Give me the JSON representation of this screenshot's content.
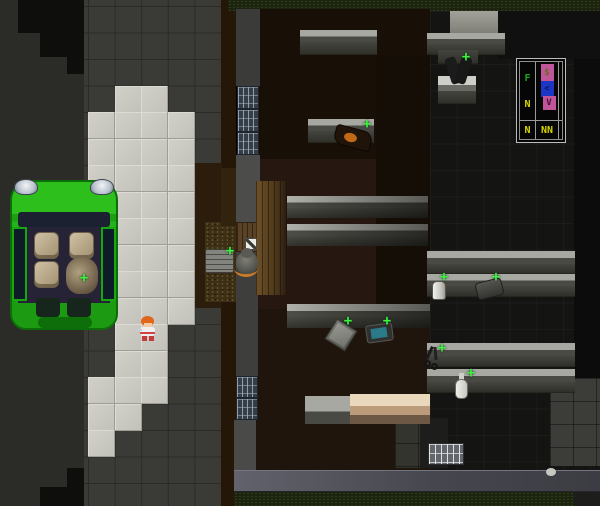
{
  "app": {
    "description": "top-down tile-based survival roguelike game viewport"
  },
  "overlay": {
    "f": "F",
    "n_mid": "N",
    "n_bottom": "N",
    "nn": "NN",
    "dollar": "$",
    "lt": "<",
    "v": "V",
    "letter_green": "#1fa21f",
    "letter_yellow": "#d6d600",
    "bar_pink": "#c0559a",
    "bar_blue": "#1c35c2"
  },
  "scene": {
    "plus_glyph": "+",
    "plus_color": "#3cf53c",
    "grid": {
      "x0": 88,
      "y0": 6,
      "tw": 26.6,
      "th": 26.5
    },
    "light_tiles": [
      [
        1,
        3
      ],
      [
        2,
        3
      ],
      [
        0,
        4
      ],
      [
        1,
        4
      ],
      [
        2,
        4
      ],
      [
        3,
        4
      ],
      [
        0,
        5
      ],
      [
        1,
        5
      ],
      [
        2,
        5
      ],
      [
        3,
        5
      ],
      [
        0,
        6
      ],
      [
        1,
        6
      ],
      [
        2,
        6
      ],
      [
        3,
        6
      ],
      [
        0,
        7
      ],
      [
        1,
        7
      ],
      [
        2,
        7
      ],
      [
        3,
        7
      ],
      [
        1,
        8
      ],
      [
        2,
        8
      ],
      [
        3,
        8
      ],
      [
        1,
        9
      ],
      [
        2,
        9
      ],
      [
        3,
        9
      ],
      [
        1,
        10
      ],
      [
        2,
        10
      ],
      [
        3,
        10
      ],
      [
        1,
        11
      ],
      [
        2,
        11
      ],
      [
        3,
        11
      ],
      [
        1,
        12
      ],
      [
        2,
        12
      ],
      [
        1,
        13
      ],
      [
        2,
        13
      ],
      [
        0,
        14
      ],
      [
        1,
        14
      ],
      [
        2,
        14
      ],
      [
        0,
        15
      ],
      [
        1,
        15
      ],
      [
        0,
        16
      ]
    ],
    "plus_markers": [
      [
        224,
        245
      ],
      [
        78,
        272
      ],
      [
        361,
        118
      ],
      [
        460,
        51
      ],
      [
        342,
        315
      ],
      [
        381,
        315
      ],
      [
        438,
        271
      ],
      [
        490,
        271
      ],
      [
        436,
        342
      ],
      [
        465,
        367
      ]
    ],
    "base": [
      {
        "n": "road-asphalt",
        "x": 0,
        "y": 0,
        "w": 88,
        "h": 506,
        "bg": "#2b2b28"
      },
      {
        "n": "road-dark-patch",
        "x": 18,
        "y": 0,
        "w": 66,
        "h": 33,
        "bg": "#0e0e0d"
      },
      {
        "n": "road-dark-patch",
        "x": 40,
        "y": 33,
        "w": 44,
        "h": 24,
        "bg": "#0e0e0d"
      },
      {
        "n": "road-dark-patch",
        "x": 67,
        "y": 57,
        "w": 17,
        "h": 17,
        "bg": "#0e0e0d"
      },
      {
        "n": "road-dark-patch",
        "x": 67,
        "y": 468,
        "w": 17,
        "h": 20,
        "bg": "#0e0e0d"
      },
      {
        "n": "road-dark-patch",
        "x": 40,
        "y": 487,
        "w": 44,
        "h": 19,
        "bg": "#0e0e0d"
      },
      {
        "n": "sidewalk-tiles",
        "x": 84,
        "y": 0,
        "w": 138,
        "h": 506,
        "c": "sidewalk"
      },
      {
        "n": "dirt-strip",
        "x": 221,
        "y": 0,
        "w": 15,
        "h": 506,
        "bg": "#241708"
      },
      {
        "n": "dirt-patch",
        "x": 194,
        "y": 163,
        "w": 28,
        "h": 145,
        "bg": "#2b1c0b"
      },
      {
        "n": "dirt-lit-patch",
        "x": 205,
        "y": 222,
        "w": 52,
        "h": 80,
        "c": "dirtlit"
      },
      {
        "n": "dirt-lit-patch",
        "x": 221,
        "y": 168,
        "w": 16,
        "h": 58,
        "bg": "#32230f"
      }
    ],
    "layers": [
      {
        "n": "grass-north-strip",
        "x": 228,
        "y": 0,
        "w": 372,
        "h": 11,
        "c": "grass"
      },
      {
        "n": "building-floor-wood",
        "x": 254,
        "y": 9,
        "w": 176,
        "h": 461,
        "bg": "#20150c"
      },
      {
        "n": "building-floor-wood-shadow",
        "x": 254,
        "y": 9,
        "w": 176,
        "h": 150,
        "bg": "#180f07"
      },
      {
        "n": "building-floor-wood-mid",
        "x": 254,
        "y": 159,
        "w": 176,
        "h": 150,
        "bg": "#261810"
      },
      {
        "n": "building-floor-dark-strip",
        "x": 376,
        "y": 55,
        "w": 54,
        "h": 255,
        "bg": "#150e07"
      },
      {
        "n": "building-floor-dark-room",
        "x": 430,
        "y": 11,
        "w": 170,
        "h": 459,
        "c": "darkgrid"
      },
      {
        "n": "building-dark-east-edge",
        "x": 574,
        "y": 11,
        "w": 26,
        "h": 367,
        "bg": "#0c0c0c"
      },
      {
        "n": "building-dark-north-corner",
        "x": 498,
        "y": 11,
        "w": 102,
        "h": 48,
        "bg": "#101010"
      },
      {
        "n": "concrete-lit-patch",
        "x": 450,
        "y": 11,
        "w": 48,
        "h": 23,
        "bg": "linear-gradient(180deg,#a2a29a,#7e7e76)"
      },
      {
        "n": "floor-tiles-patch",
        "x": 395,
        "y": 420,
        "w": 52,
        "h": 48,
        "c": "gtile2"
      },
      {
        "n": "floor-step-dark",
        "x": 420,
        "y": 418,
        "w": 28,
        "h": 50,
        "bg": "#1d1d1b"
      },
      {
        "n": "floor-tiles-patch",
        "x": 550,
        "y": 378,
        "w": 50,
        "h": 88,
        "c": "gtile2b"
      },
      {
        "n": "wall-west-upper",
        "x": 236,
        "y": 9,
        "w": 24,
        "h": 77,
        "bg": "#3b3b39"
      },
      {
        "n": "window-west",
        "x": 237,
        "y": 86,
        "w": 22,
        "h": 23,
        "c": "window"
      },
      {
        "n": "window-west",
        "x": 237,
        "y": 109,
        "w": 22,
        "h": 23,
        "c": "window"
      },
      {
        "n": "window-west",
        "x": 237,
        "y": 132,
        "w": 22,
        "h": 23,
        "c": "window"
      },
      {
        "n": "wall-west-mid",
        "x": 236,
        "y": 155,
        "w": 24,
        "h": 67,
        "bg": "#4c4c4a"
      },
      {
        "n": "door-wood",
        "x": 236,
        "y": 222,
        "w": 24,
        "h": 30,
        "c": "doorwood",
        "i": true
      },
      {
        "n": "wall-west-lower",
        "x": 236,
        "y": 252,
        "w": 22,
        "h": 124,
        "bg": "#3e3e3c"
      },
      {
        "n": "window-west",
        "x": 236,
        "y": 376,
        "w": 22,
        "h": 22,
        "c": "window"
      },
      {
        "n": "window-west",
        "x": 236,
        "y": 398,
        "w": 22,
        "h": 22,
        "c": "window"
      },
      {
        "n": "wall-west-bottom",
        "x": 234,
        "y": 420,
        "w": 22,
        "h": 52,
        "bg": "#4a4a48"
      },
      {
        "n": "wall-south",
        "x": 234,
        "y": 470,
        "w": 366,
        "h": 22,
        "c": "southwall"
      },
      {
        "n": "grass-south-strip",
        "x": 234,
        "y": 492,
        "w": 366,
        "h": 14,
        "c": "grass"
      },
      {
        "n": "building-corner-dark-se",
        "x": 574,
        "y": 492,
        "w": 26,
        "h": 14,
        "bg": "#1d1d1b"
      },
      {
        "n": "window-bright-south",
        "x": 428,
        "y": 443,
        "w": 36,
        "h": 22,
        "c": "windowbright"
      },
      {
        "n": "wood-floor-lit",
        "x": 256,
        "y": 181,
        "w": 32,
        "h": 114,
        "c": "woodlit"
      },
      {
        "n": "shelf-row",
        "x": 300,
        "y": 30,
        "w": 77,
        "h": 12,
        "c": "srow"
      },
      {
        "n": "shelf-front",
        "x": 300,
        "y": 42,
        "w": 77,
        "h": 13,
        "c": "srowd"
      },
      {
        "n": "shelf-row",
        "x": 427,
        "y": 33,
        "w": 78,
        "h": 11,
        "c": "srow"
      },
      {
        "n": "shelf-front",
        "x": 427,
        "y": 44,
        "w": 78,
        "h": 11,
        "c": "srowd"
      },
      {
        "n": "shelf-front",
        "x": 438,
        "y": 50,
        "w": 40,
        "h": 14,
        "c": "srowd"
      },
      {
        "n": "shelf-row-bright",
        "x": 438,
        "y": 76,
        "w": 38,
        "h": 15,
        "c": "srowbr"
      },
      {
        "n": "shelf-front",
        "x": 438,
        "y": 91,
        "w": 38,
        "h": 13,
        "c": "srowd"
      },
      {
        "n": "shelf-row",
        "x": 308,
        "y": 119,
        "w": 66,
        "h": 12,
        "c": "srow"
      },
      {
        "n": "shelf-front",
        "x": 308,
        "y": 131,
        "w": 66,
        "h": 12,
        "c": "srowd"
      },
      {
        "n": "shelf-row-long",
        "x": 287,
        "y": 196,
        "w": 141,
        "h": 12,
        "c": "srowL"
      },
      {
        "n": "shelf-front-long",
        "x": 287,
        "y": 208,
        "w": 141,
        "h": 10,
        "c": "srowdL"
      },
      {
        "n": "shelf-row-long",
        "x": 287,
        "y": 224,
        "w": 141,
        "h": 12,
        "c": "srowL"
      },
      {
        "n": "shelf-front-long",
        "x": 287,
        "y": 236,
        "w": 141,
        "h": 10,
        "c": "srowdL"
      },
      {
        "n": "shelf-row-long",
        "x": 287,
        "y": 304,
        "w": 143,
        "h": 13,
        "c": "srowL"
      },
      {
        "n": "shelf-front-long",
        "x": 287,
        "y": 317,
        "w": 143,
        "h": 11,
        "c": "srowdL"
      },
      {
        "n": "shelf-row",
        "x": 427,
        "y": 251,
        "w": 148,
        "h": 13,
        "c": "srow"
      },
      {
        "n": "shelf-front",
        "x": 427,
        "y": 264,
        "w": 148,
        "h": 10,
        "c": "srowd"
      },
      {
        "n": "shelf-row",
        "x": 427,
        "y": 274,
        "w": 148,
        "h": 12,
        "c": "srow"
      },
      {
        "n": "shelf-front",
        "x": 427,
        "y": 286,
        "w": 148,
        "h": 11,
        "c": "srowd"
      },
      {
        "n": "shelf-row",
        "x": 427,
        "y": 343,
        "w": 148,
        "h": 13,
        "c": "srow"
      },
      {
        "n": "shelf-front",
        "x": 427,
        "y": 356,
        "w": 148,
        "h": 11,
        "c": "srowd"
      },
      {
        "n": "shelf-row",
        "x": 427,
        "y": 369,
        "w": 148,
        "h": 13,
        "c": "srow"
      },
      {
        "n": "shelf-front",
        "x": 427,
        "y": 382,
        "w": 148,
        "h": 11,
        "c": "srowd"
      },
      {
        "n": "counter-gray",
        "x": 305,
        "y": 396,
        "w": 58,
        "h": 28,
        "c": "srow"
      },
      {
        "n": "counter-tan",
        "x": 350,
        "y": 394,
        "w": 80,
        "h": 30,
        "c": "countertan"
      },
      {
        "n": "pallet-crate",
        "x": 205,
        "y": 249,
        "w": 29,
        "h": 24,
        "c": "pallet",
        "i": true
      },
      {
        "n": "item-box-white",
        "x": 245,
        "y": 238,
        "w": 12,
        "h": 12,
        "c": "whitebox",
        "i": true
      },
      {
        "n": "zombie-sprite-body",
        "x": 236,
        "y": 252,
        "w": 22,
        "h": 22,
        "c": "zbody",
        "i": true
      },
      {
        "n": "zombie-sprite-head",
        "x": 241,
        "y": 248,
        "w": 12,
        "h": 10,
        "bg": "#5a5a54",
        "rad": "50%",
        "i": true
      },
      {
        "n": "zombie-sprite-orange-arc",
        "x": 234,
        "y": 260,
        "w": 24,
        "h": 14,
        "c": "zarc"
      },
      {
        "n": "vehicle-car-body",
        "x": 10,
        "y": 180,
        "w": 108,
        "h": 150,
        "c": "carbody",
        "i": true
      },
      {
        "n": "car-headlight",
        "x": 14,
        "y": 179,
        "w": 24,
        "h": 16,
        "c": "headlight"
      },
      {
        "n": "car-headlight",
        "x": 90,
        "y": 179,
        "w": 24,
        "h": 16,
        "c": "headlight"
      },
      {
        "n": "car-windshield",
        "x": 18,
        "y": 212,
        "w": 92,
        "h": 15,
        "bg": "#1b2130",
        "rad": "3px"
      },
      {
        "n": "car-cabin",
        "x": 18,
        "y": 227,
        "w": 92,
        "h": 76,
        "bg": "#272336"
      },
      {
        "n": "car-door-left",
        "x": 12,
        "y": 227,
        "w": 15,
        "h": 74,
        "c": "cardoor",
        "i": true
      },
      {
        "n": "car-door-right",
        "x": 101,
        "y": 227,
        "w": 15,
        "h": 74,
        "c": "cardoor",
        "i": true
      },
      {
        "n": "car-seat",
        "x": 34,
        "y": 232,
        "w": 25,
        "h": 27,
        "c": "seat",
        "i": true
      },
      {
        "n": "car-seat",
        "x": 69,
        "y": 232,
        "w": 25,
        "h": 27,
        "c": "seat",
        "i": true
      },
      {
        "n": "car-seat",
        "x": 34,
        "y": 261,
        "w": 25,
        "h": 27,
        "c": "seat",
        "i": true
      },
      {
        "n": "car-seat",
        "x": 69,
        "y": 261,
        "w": 25,
        "h": 27,
        "c": "seat",
        "i": true
      },
      {
        "n": "car-cargo-pile",
        "x": 66,
        "y": 258,
        "w": 32,
        "h": 36,
        "c": "pile",
        "i": true
      },
      {
        "n": "car-trunk-inset",
        "x": 36,
        "y": 298,
        "w": 24,
        "h": 19,
        "bg": "#16261c",
        "rad": "4px"
      },
      {
        "n": "car-trunk-inset",
        "x": 67,
        "y": 298,
        "w": 24,
        "h": 19,
        "bg": "#16261c",
        "rad": "4px"
      },
      {
        "n": "car-rear-bumper",
        "x": 38,
        "y": 317,
        "w": 54,
        "h": 11,
        "bg": "#0e6e09",
        "rad": "6px"
      },
      {
        "n": "player-hair",
        "x": 141,
        "y": 316,
        "w": 13,
        "h": 10,
        "bg": "#e0661c",
        "rad": "50% 50% 45% 45%",
        "i": true
      },
      {
        "n": "player-face",
        "x": 144,
        "y": 323,
        "w": 8,
        "h": 5,
        "bg": "#f2cba2",
        "i": true
      },
      {
        "n": "player-torso",
        "x": 140,
        "y": 327,
        "w": 15,
        "h": 9,
        "bg": "linear-gradient(180deg,#efefef 0 55%,#d24343 55% 75%,#efefef 75%)",
        "rad": "3px",
        "i": true
      },
      {
        "n": "player-sword",
        "x": 134,
        "y": 329,
        "w": 8,
        "h": 2,
        "bg": "#c9ccd4"
      },
      {
        "n": "player-leg",
        "x": 142,
        "y": 336,
        "w": 5,
        "h": 5,
        "bg": "#c23c3c"
      },
      {
        "n": "player-leg",
        "x": 149,
        "y": 336,
        "w": 5,
        "h": 5,
        "bg": "#c23c3c"
      },
      {
        "n": "item-guitar",
        "x": 334,
        "y": 128,
        "w": 38,
        "h": 20,
        "bg": "#20130a",
        "rad": "4px 10px 4px 10px",
        "rot": 15,
        "bd": "1px solid #0c0702",
        "i": true
      },
      {
        "n": "item-guitar-detail",
        "x": 344,
        "y": 133,
        "w": 13,
        "h": 9,
        "bg": "#c06a18",
        "rad": "50%",
        "rot": 15
      },
      {
        "n": "item-clothes-dark",
        "x": 448,
        "y": 57,
        "w": 11,
        "h": 27,
        "bg": "#1b1b1b",
        "rot": -18,
        "rad": "3px",
        "i": true
      },
      {
        "n": "item-clothes-dark",
        "x": 458,
        "y": 57,
        "w": 11,
        "h": 27,
        "bg": "#181818",
        "rot": 18,
        "rad": "3px",
        "i": true
      },
      {
        "n": "item-box-diamond",
        "x": 329,
        "y": 323,
        "w": 24,
        "h": 24,
        "c": "xbox",
        "rot": 32,
        "i": true
      },
      {
        "n": "item-tablet",
        "x": 366,
        "y": 324,
        "w": 27,
        "h": 18,
        "bg": "#30302e",
        "bd": "1px solid #565652",
        "rad": "3px",
        "rot": -8,
        "i": true
      },
      {
        "n": "item-tablet-screen",
        "x": 371,
        "y": 328,
        "w": 16,
        "h": 10,
        "bg": "#2a7a88",
        "rot": -8
      },
      {
        "n": "item-can",
        "x": 432,
        "y": 281,
        "w": 14,
        "h": 19,
        "c": "can",
        "i": true
      },
      {
        "n": "item-wallet",
        "x": 476,
        "y": 280,
        "w": 27,
        "h": 18,
        "c": "wallet",
        "rot": -14,
        "i": true
      },
      {
        "n": "item-scissors-blade",
        "x": 428,
        "y": 346,
        "w": 3,
        "h": 14,
        "bg": "#1a1a1a",
        "rot": 25,
        "i": true
      },
      {
        "n": "item-scissors-blade",
        "x": 434,
        "y": 347,
        "w": 3,
        "h": 13,
        "bg": "#222222",
        "rot": -5,
        "i": true
      },
      {
        "n": "item-scissors-ring",
        "x": 424,
        "y": 360,
        "w": 7,
        "h": 7,
        "c": "ring",
        "i": true
      },
      {
        "n": "item-scissors-ring",
        "x": 431,
        "y": 363,
        "w": 7,
        "h": 7,
        "c": "ring",
        "i": true
      },
      {
        "n": "item-bottle-neck",
        "x": 459,
        "y": 373,
        "w": 5,
        "h": 8,
        "bg": "#cfcfc7"
      },
      {
        "n": "item-bottle",
        "x": 455,
        "y": 379,
        "w": 13,
        "h": 20,
        "c": "bottle",
        "i": true
      },
      {
        "n": "item-small-white",
        "x": 546,
        "y": 468,
        "w": 10,
        "h": 8,
        "bg": "#c8c8c2",
        "rad": "50%",
        "i": true
      }
    ]
  }
}
